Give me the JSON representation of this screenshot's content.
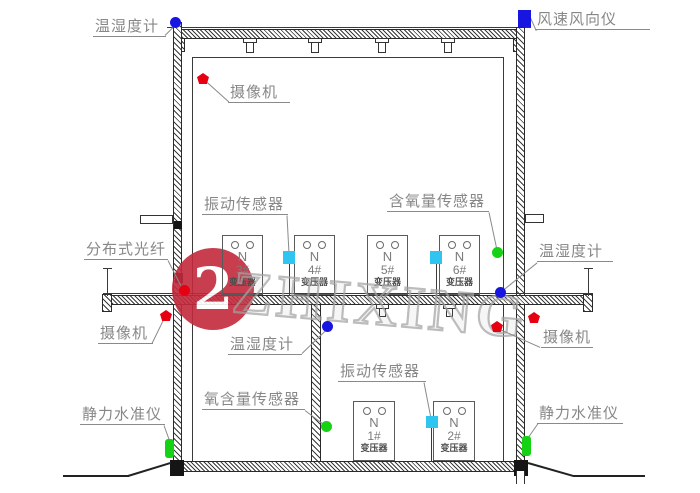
{
  "annotations": [
    {
      "id": "humidity-top-left",
      "text": "温湿度计",
      "marker": "circle",
      "color": "#1616e0"
    },
    {
      "id": "wind-top-right",
      "text": "风速风向仪",
      "marker": "square",
      "color": "#1616e0"
    },
    {
      "id": "camera-top",
      "text": "摄像机",
      "marker": "pentagon",
      "color": "#e60012"
    },
    {
      "id": "vibration-ground",
      "text": "振动传感器",
      "marker": "square",
      "color": "#30c4f0"
    },
    {
      "id": "oxygen-ground",
      "text": "含氧量传感器",
      "marker": "circle",
      "color": "#15d215"
    },
    {
      "id": "fiber-left",
      "text": "分布式光纤",
      "marker": "circle",
      "color": "#e60012"
    },
    {
      "id": "humidity-right",
      "text": "温湿度计",
      "marker": "circle",
      "color": "#1616e0"
    },
    {
      "id": "camera-mid-left",
      "text": "摄像机",
      "marker": "pentagon",
      "color": "#e60012"
    },
    {
      "id": "camera-mid-right",
      "text": "摄像机",
      "marker": "pentagon",
      "color": "#e60012"
    },
    {
      "id": "humidity-basement",
      "text": "温湿度计",
      "marker": "circle",
      "color": "#1616e0"
    },
    {
      "id": "oxygen-basement",
      "text": "氧含量传感器",
      "marker": "circle",
      "color": "#15d215"
    },
    {
      "id": "vibration-basement",
      "text": "振动传感器",
      "marker": "square",
      "color": "#30c4f0"
    },
    {
      "id": "level-left",
      "text": "静力水准仪",
      "marker": "bar",
      "color": "#15d215"
    },
    {
      "id": "level-right",
      "text": "静力水准仪",
      "marker": "bar",
      "color": "#15d215"
    }
  ],
  "transformers": [
    {
      "n": "N",
      "num": "3#",
      "name": "变压器"
    },
    {
      "n": "N",
      "num": "4#",
      "name": "变压器"
    },
    {
      "n": "N",
      "num": "5#",
      "name": "变压器"
    },
    {
      "n": "N",
      "num": "6#",
      "name": "变压器"
    },
    {
      "n": "N",
      "num": "1#",
      "name": "变压器"
    },
    {
      "n": "N",
      "num": "2#",
      "name": "变压器"
    }
  ],
  "watermark": {
    "logo_glyph": "2",
    "text": "ZHIXING"
  },
  "colors": {
    "camera": "#e60012",
    "temp_humidity": "#1616e0",
    "wind": "#1616e0",
    "vibration": "#30c4f0",
    "oxygen": "#15d215",
    "level": "#15d215",
    "fiber": "#e60012",
    "watermark_red": "#c32a3c",
    "structure": "#2a2a2a",
    "label_text": "#878787"
  }
}
